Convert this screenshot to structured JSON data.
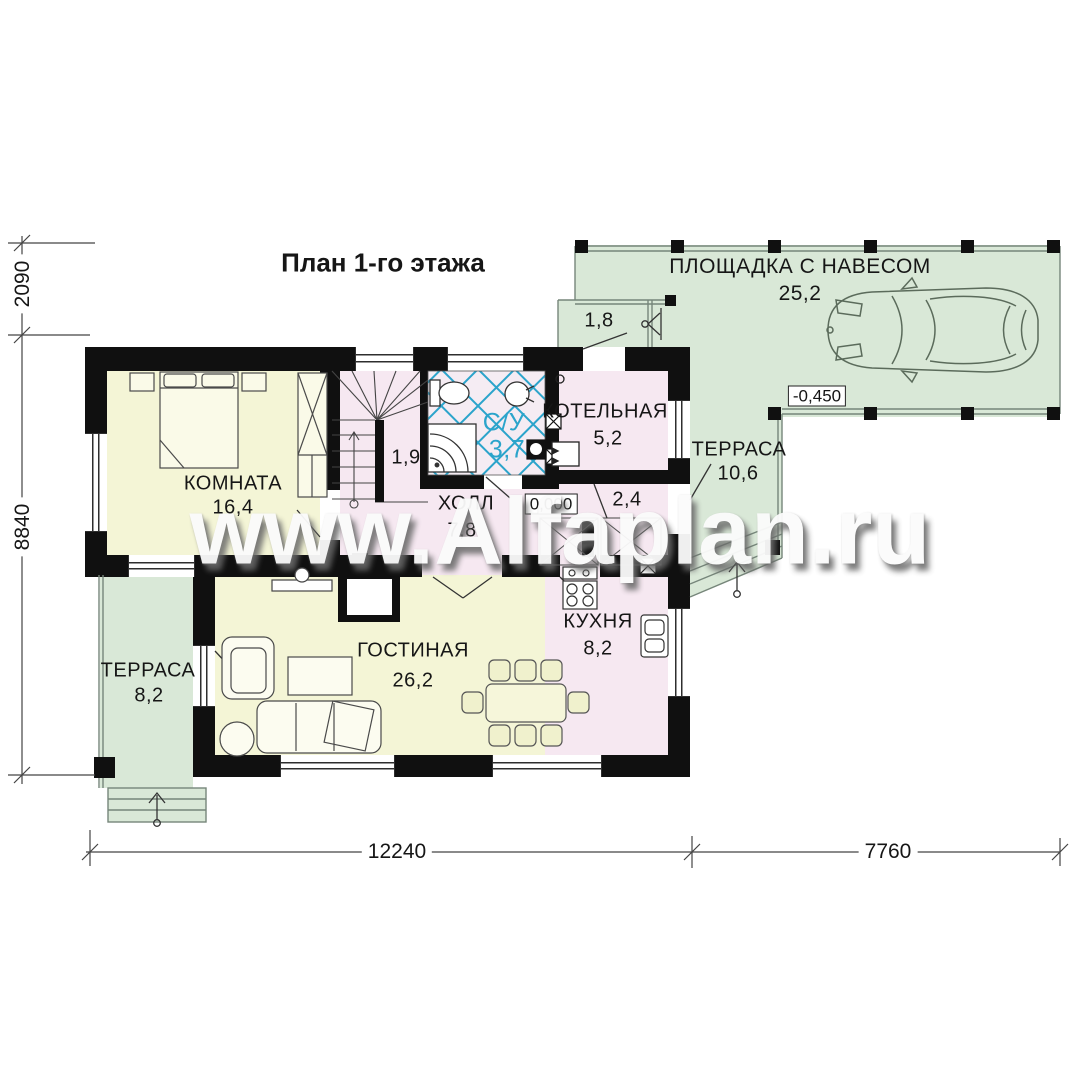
{
  "title": "План 1-го этажа",
  "watermark": "www.Alfaplan.ru",
  "canopy": {
    "name": "ПЛОЩАДКА С НАВЕСОМ",
    "area": "25,2",
    "elevation": "-0,450"
  },
  "porch": {
    "area": "1,8"
  },
  "rooms": {
    "bedroom": {
      "name": "КОМНАТА",
      "area": "16,4"
    },
    "living": {
      "name": "ГОСТИНАЯ",
      "area": "26,2"
    },
    "kitchen": {
      "name": "КУХНЯ",
      "area": "8,2"
    },
    "hall": {
      "name": "ХОЛЛ",
      "area": "7,8",
      "elevation": "0,000"
    },
    "bath": {
      "name": "С/У",
      "area": "3,7"
    },
    "boiler": {
      "name": "КОТЕЛЬНАЯ",
      "area": "5,2"
    },
    "vestibule": {
      "area": "2,4"
    },
    "stair_closet": {
      "area": "1,9"
    },
    "terrace_left": {
      "name": "ТЕРРАСА",
      "area": "8,2"
    },
    "terrace_right": {
      "name": "ТЕРРАСА",
      "area": "10,6"
    }
  },
  "dimensions": {
    "left_top": "2090",
    "left_main": "8840",
    "bottom_left": "12240",
    "bottom_right": "7760"
  },
  "colors": {
    "room_yellow": "#f4f5d6",
    "room_pink": "#f6e8f1",
    "terrace_green": "#d9e8d7",
    "bath_blue": "#2ba4cb",
    "wall": "#101010"
  }
}
